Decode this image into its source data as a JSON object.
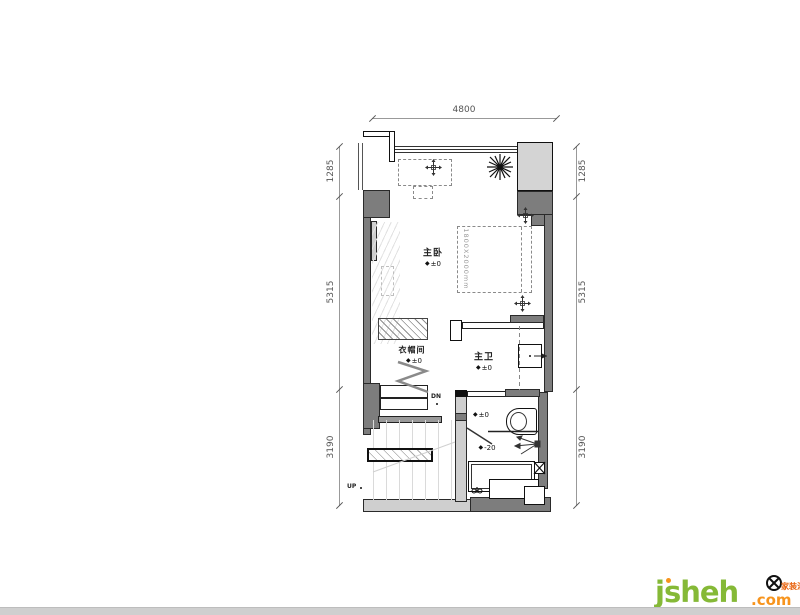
{
  "plan": {
    "dimensions": {
      "top": "4800",
      "left": [
        "1285",
        "5315",
        "3190"
      ],
      "right": [
        "1285",
        "5315",
        "3190"
      ]
    },
    "rooms": {
      "bedroom": "主卧",
      "cloakroom": "衣帽间",
      "bathroom": "主卫"
    },
    "levels": {
      "icon": "◆",
      "bedroom": "±0",
      "cloakroom": "±0",
      "bathroom": "±0",
      "shower_upper": "±0",
      "shower_lower": "-20"
    },
    "bed_size_label": "1800X2000mm",
    "stairs": {
      "down": "DN",
      "up": "UP"
    }
  },
  "watermark": {
    "brand": "jsheh",
    "suffix": ".com",
    "logo_text": "家装汇"
  }
}
